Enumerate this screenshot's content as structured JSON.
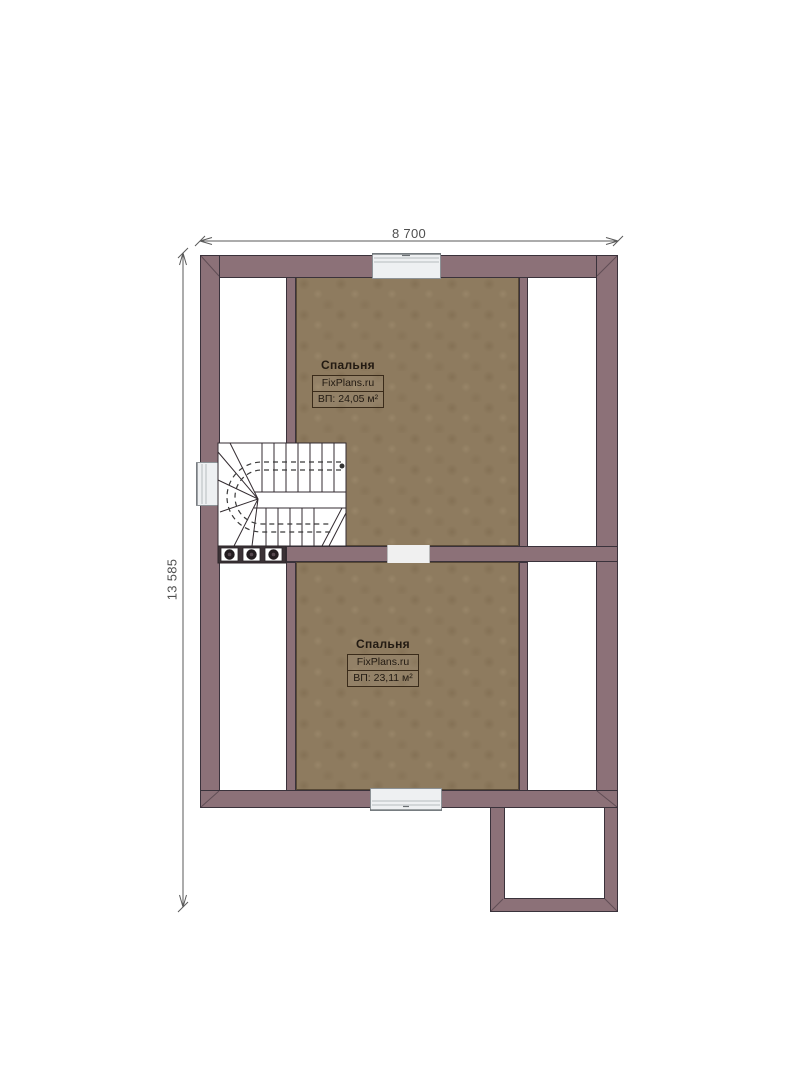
{
  "plan": {
    "dimensions": {
      "width_label": "8 700",
      "height_label": "13 585"
    },
    "rooms": [
      {
        "name": "Спальня",
        "brand": "FixPlans.ru",
        "area": "ВП: 24,05 м²"
      },
      {
        "name": "Спальня",
        "brand": "FixPlans.ru",
        "area": "ВП: 23,11 м²"
      }
    ],
    "features": {
      "staircase": "u-shaped-winder-stair",
      "windows": [
        "top-center",
        "left-side",
        "bottom-center"
      ],
      "door_openings": [
        "between-bedrooms"
      ],
      "extension": "bottom-right-annex"
    },
    "colors": {
      "wall": "#8c7178",
      "wall_outline": "#3a323b",
      "floor": "#8e7b5f",
      "window_fill": "#eef0f2",
      "dimension_text": "#4f4f4f",
      "label_text": "#221a12"
    }
  }
}
